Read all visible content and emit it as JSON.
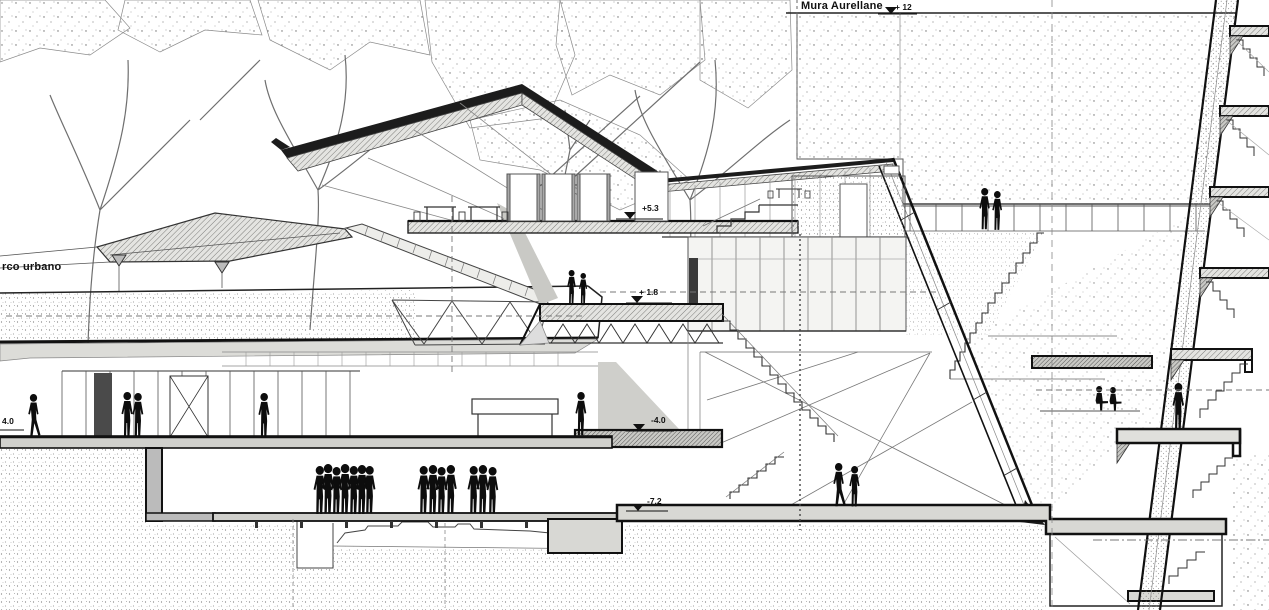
{
  "document": {
    "type": "architectural-section-drawing",
    "labels": {
      "wall_name": "Mura Aurellane",
      "park": "rco urbano"
    },
    "level_markers": {
      "top": "+ 12",
      "terrace": "+5.3",
      "mezzanine": "+ 1.8",
      "lower": "-4.0",
      "basement": "-7.2",
      "left_floor": "4.0"
    },
    "colors": {
      "ink": "#1c1c1c",
      "line": "#555555",
      "paper": "#ffffff",
      "fill_light": "#e9e9e6",
      "fill_mid": "#d6d6d2",
      "silhouette": "#0d0d0d"
    }
  }
}
